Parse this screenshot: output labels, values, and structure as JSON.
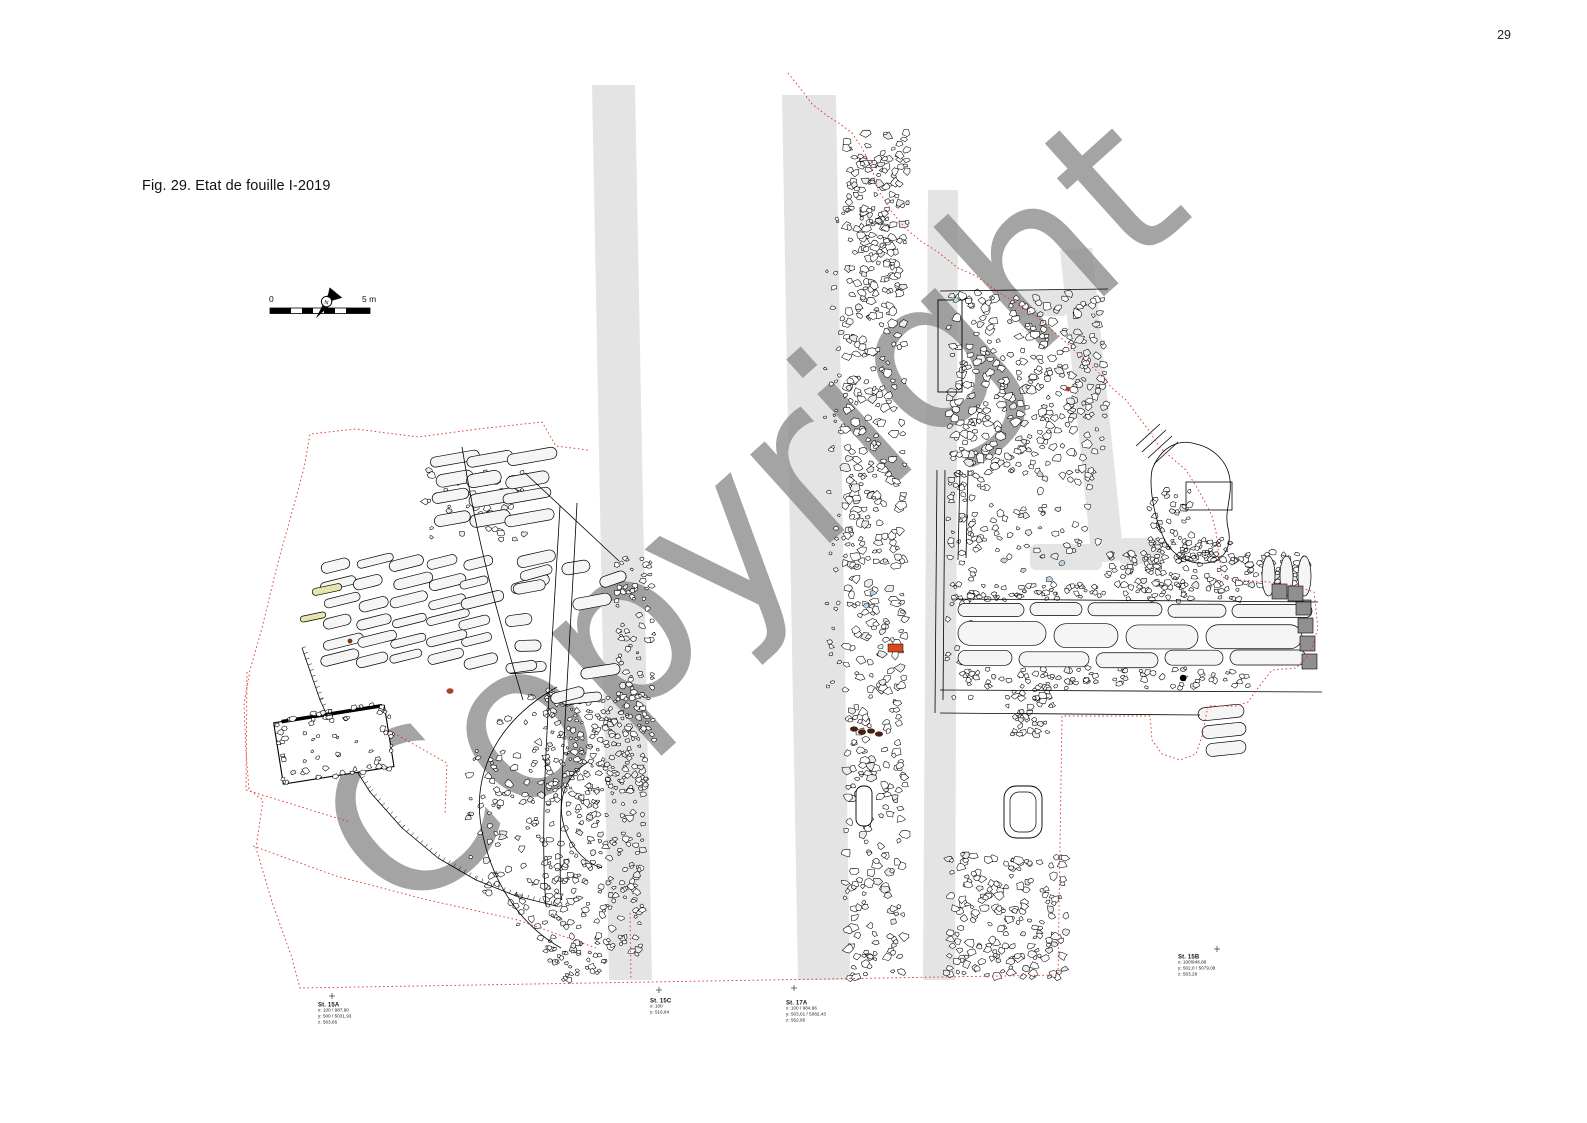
{
  "page": {
    "number": "29"
  },
  "figure": {
    "caption": "Fig. 29. Etat de fouille I-2019"
  },
  "watermark": {
    "text": "Copyright"
  },
  "scalebar": {
    "left_label": "0",
    "right_label": "5 m"
  },
  "north_arrow": {
    "label": "N"
  },
  "stations": [
    {
      "id": "St. 15A",
      "lines": [
        "x: 100 / 987,90",
        "y: 500 / 5031,93",
        "z: 563,66"
      ]
    },
    {
      "id": "St. 15C",
      "lines": [
        "x: 100",
        "y: 516,84"
      ]
    },
    {
      "id": "St. 17A",
      "lines": [
        "x: 100 / 984,96",
        "y: 503,01 / 5082,43",
        "z: 562,96"
      ]
    },
    {
      "id": "St. 15B",
      "lines": [
        "x: 100/948,88",
        "y: 502,0 / 5079,08",
        "z: 563,28"
      ]
    }
  ],
  "colors": {
    "boundary_red": "#de3226",
    "band_grey": "#e4e4e4",
    "watermark_grey": "#8e8e8e",
    "slab_fill": "#f5f5f5",
    "stone_fill": "#ffffff",
    "dark_grey": "#8f8f8f",
    "accent_blue": "#bdd7e7",
    "accent_orange": "#d8481c",
    "accent_maroon": "#47200f",
    "accent_redbrown": "#a8402c",
    "accent_yellow": "#e8e4ac",
    "line_black": "#000000"
  }
}
